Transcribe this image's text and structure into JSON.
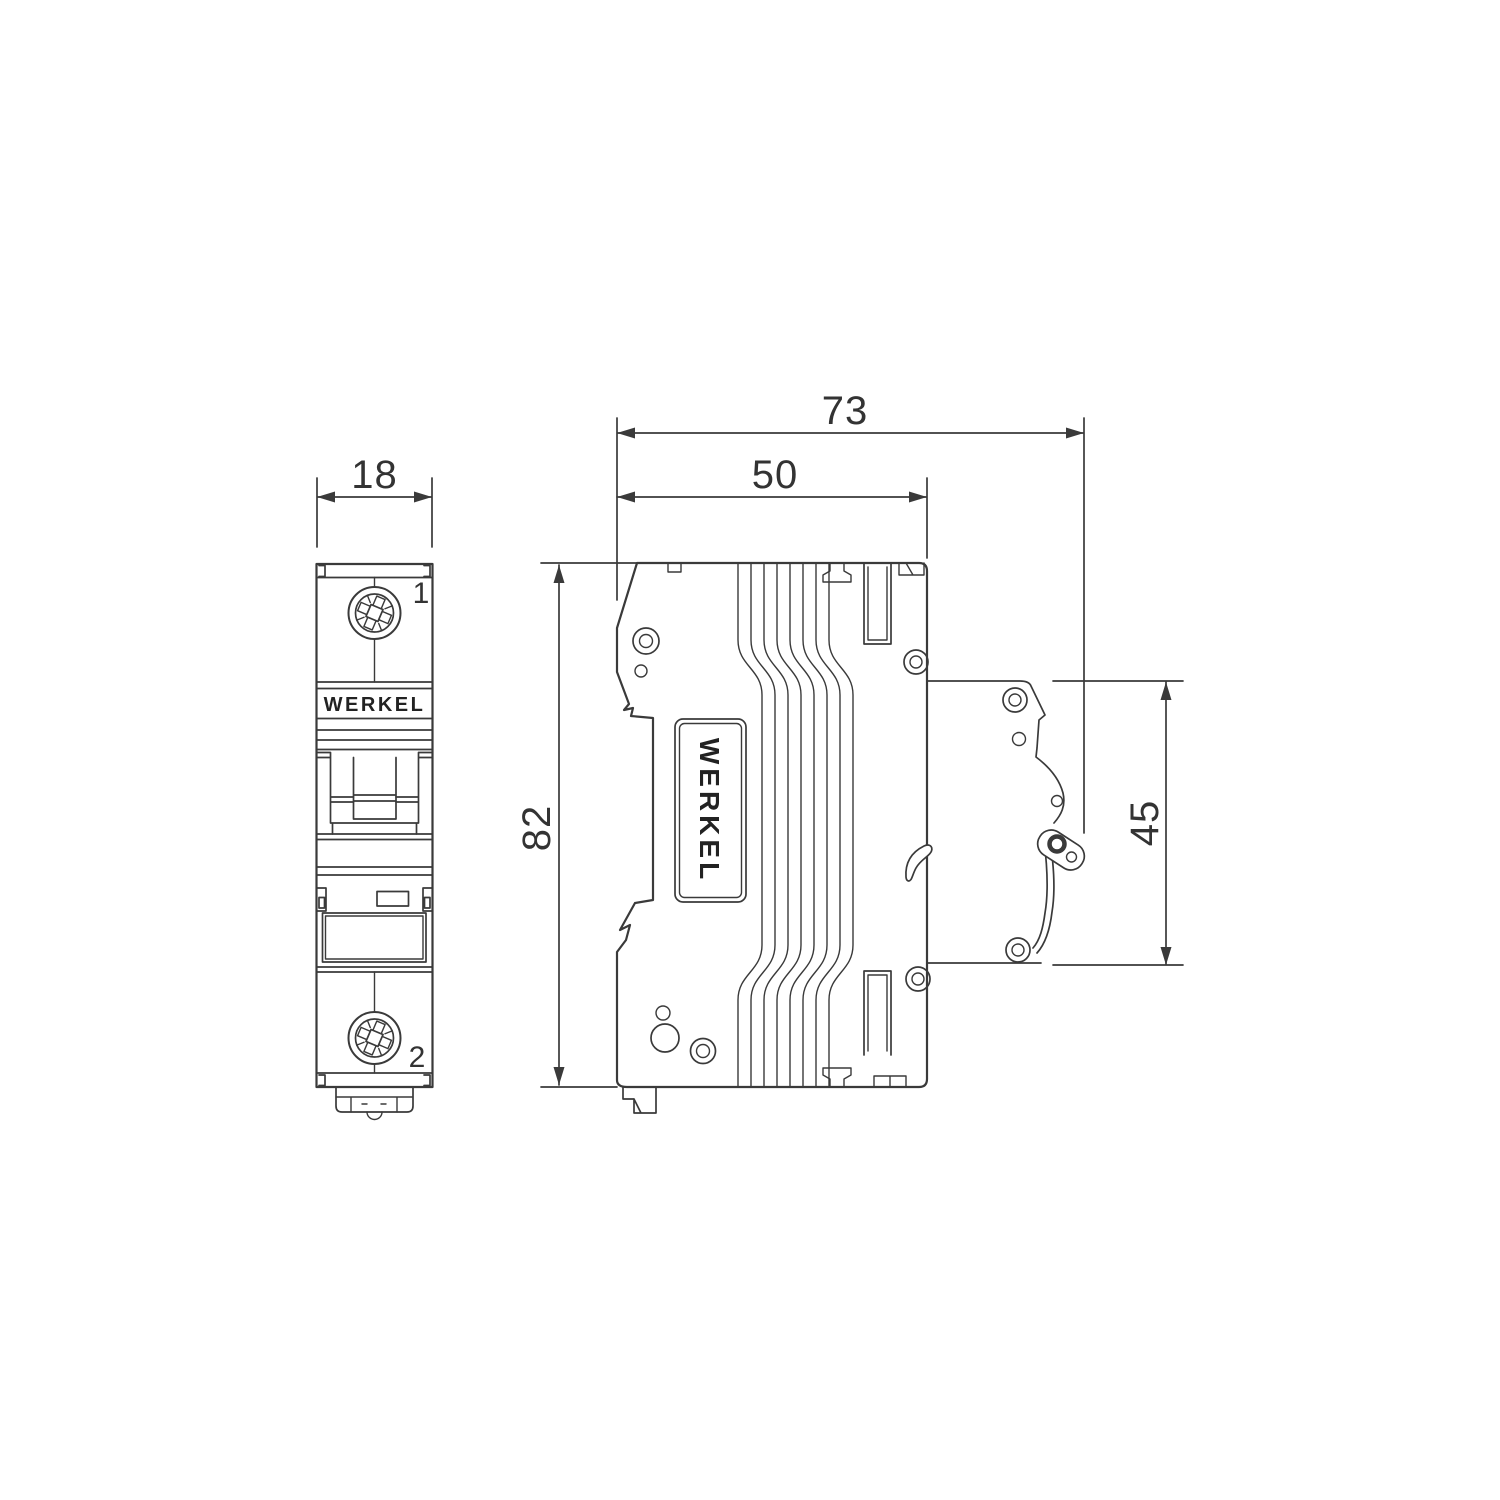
{
  "drawing": {
    "type": "technical-dimension-diagram",
    "subject": "single-pole modular circuit breaker",
    "brand": "WERKEL",
    "views": {
      "front_view": {
        "brand_label": "WERKEL",
        "terminal_top_label": "1",
        "terminal_bottom_label": "2"
      },
      "side_view": {
        "brand_label": "WERKEL"
      }
    },
    "dimensions": {
      "front_width_mm": "18",
      "overall_depth_mm": "73",
      "body_depth_mm": "50",
      "height_mm": "82",
      "din_section_height_mm": "45"
    },
    "icons": [
      "pozidriv-screw-icon",
      "rivet-ring-icon",
      "din-clip-icon",
      "latch-lever-icon"
    ],
    "colors": {
      "line": "#3a3a3a",
      "text": "#333333",
      "background": "#ffffff"
    }
  }
}
